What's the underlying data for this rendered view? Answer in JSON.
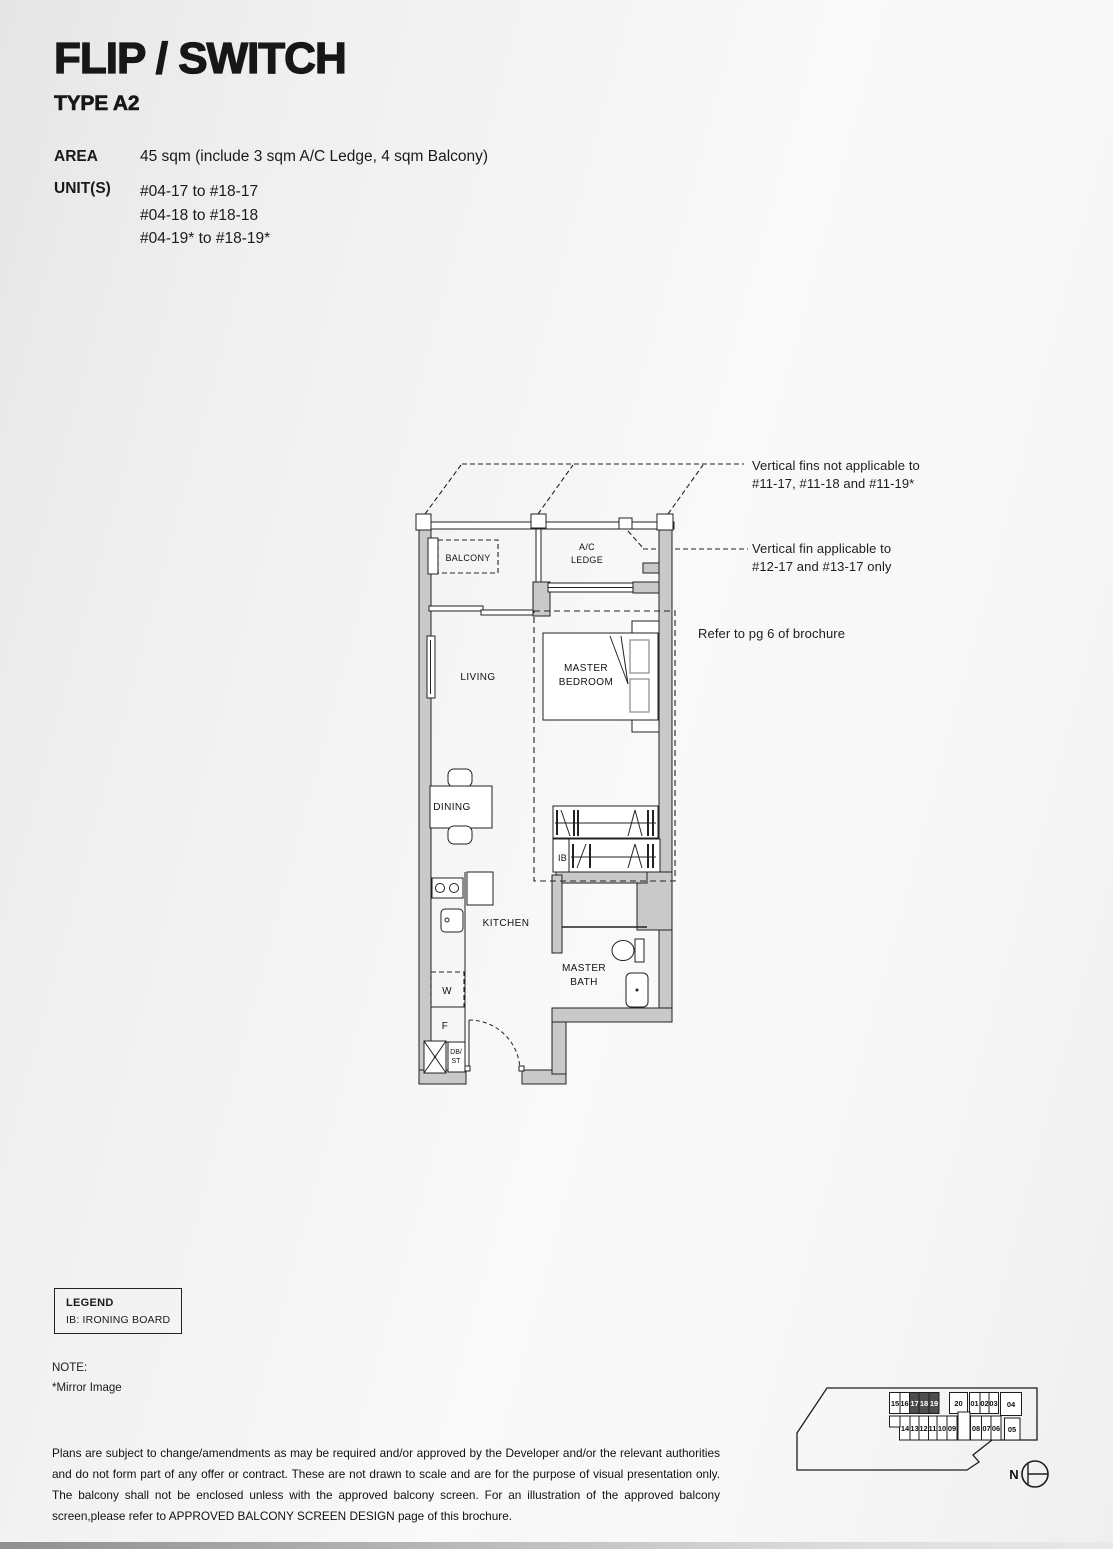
{
  "header": {
    "title": "FLIP / SWITCH",
    "subtitle": "TYPE A2",
    "area_label": "AREA",
    "area_value": "45 sqm (include 3 sqm A/C Ledge, 4 sqm Balcony)",
    "units_label": "UNIT(S)",
    "units": [
      "#04-17 to #18-17",
      "#04-18 to #18-18",
      "#04-19* to #18-19*"
    ]
  },
  "annotations": {
    "fins_line1": "Vertical fins not applicable to",
    "fins_line2": "#11-17, #11-18 and #11-19*",
    "fin_line1": "Vertical fin applicable to",
    "fin_line2": "#12-17 and #13-17 only",
    "refer": "Refer to pg 6 of brochure"
  },
  "plan": {
    "labels": {
      "balcony": "BALCONY",
      "ac_ledge_line1": "A/C",
      "ac_ledge_line2": "LEDGE",
      "living": "LIVING",
      "master_bedroom_line1": "MASTER",
      "master_bedroom_line2": "BEDROOM",
      "dining": "DINING",
      "kitchen": "KITCHEN",
      "master_bath_line1": "MASTER",
      "master_bath_line2": "BATH",
      "ironing_board": "IB",
      "washer": "W",
      "fridge": "F",
      "db_line1": "DB/",
      "db_line2": "ST"
    }
  },
  "legend": {
    "title": "LEGEND",
    "items": [
      "IB: IRONING BOARD"
    ]
  },
  "note": {
    "title": "NOTE:",
    "line": "*Mirror Image"
  },
  "disclaimer": "Plans are subject to change/amendments as may be required and/or approved by the Developer and/or the relevant authorities and do not form part of any offer or contract. These are not drawn to scale and are for the purpose of visual presentation only. The balcony shall not be enclosed unless with the approved balcony screen. For an illustration of the approved balcony screen,please refer to APPROVED BALCONY SCREEN DESIGN page of this brochure.",
  "keyplan": {
    "top_row": [
      "15",
      "16",
      "17",
      "18",
      "19",
      "20",
      "01",
      "02",
      "03",
      "04"
    ],
    "bottom_row": [
      "14",
      "13",
      "12",
      "11",
      "10",
      "09",
      "08",
      "07",
      "06",
      "05"
    ],
    "highlighted_units": [
      "17",
      "18",
      "19"
    ],
    "north_label": "N"
  },
  "colors": {
    "wall_gray": "#c9c9c9",
    "line_black": "#222222",
    "highlight_dark": "#4d4d4d",
    "page_bg": "#f0f0f0"
  }
}
